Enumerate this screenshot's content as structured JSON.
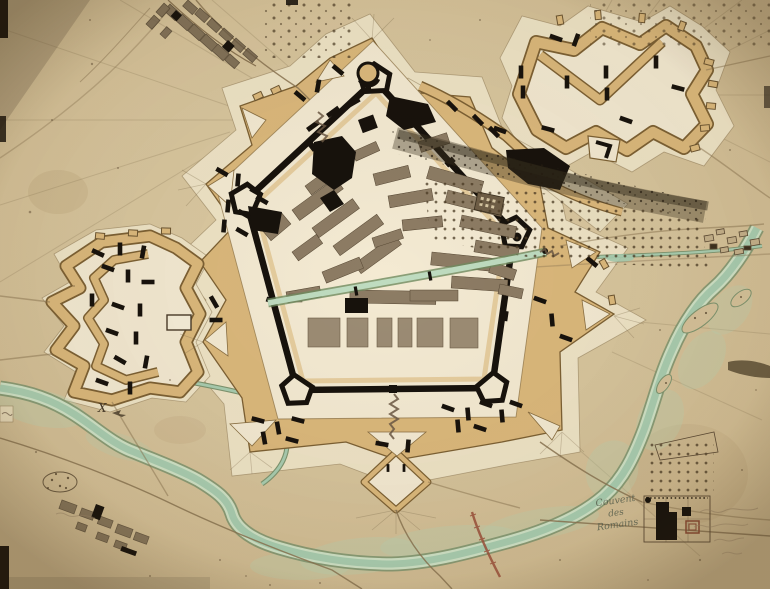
{
  "map": {
    "kind": "hand-drawn fortification plan of a pentagonal star-fort town on aged paper",
    "labels": {
      "convent": {
        "line1": "Couvent",
        "line2": "des",
        "line3": "Romains"
      },
      "x_mark": "X",
      "signature": {
        "note": "faint illegible handwriting, four short lines, lower right corner"
      },
      "village_label": {
        "note": "faint illegible cursive place-name beside south-west village"
      },
      "edge_fragment": {
        "note": "tiny clipped label fragment at left edge"
      }
    },
    "features": [
      "pentagonal citadel wall with five bastions and round north tower",
      "fortified town blocks (north half of citadel)",
      "esplanade with row of barracks blocks (south half)",
      "canal crossing the town",
      "hornwork outwork (north-east)",
      "crownwork outwork (west)",
      "ravelins, glacis and covered way with traverses",
      "south diamond ravelin with zigzag causeway",
      "river with islands (south and east)",
      "mill stream (east)",
      "crownwork moat stream",
      "suburb street grid (north-west)",
      "village (south-west)",
      "convent enclosure with garden and orchard (south-east)",
      "orchard of dotted trees (north-east slope)",
      "dark wooded escarpment shading",
      "small pentagonal redoubt (north-west)"
    ],
    "colors": {
      "paper": "#d5c29a",
      "paper_light": "#e6d6ae",
      "glacis": "#efe4c6",
      "ditch": "#f4ead2",
      "rampart_tan": "#dcb97c",
      "rampart_edge": "#7d6134",
      "ink_black": "#17120c",
      "building_gray": "#8d7c64",
      "building_light": "#9c8c74",
      "water": "#a9cdb0",
      "water_edge": "#7e946f",
      "marsh": "#b9d4b4",
      "road": "#8a7452",
      "shadow": "#3f3422",
      "stain": "#8a6a3c",
      "causeway_red": "#9b4f3a",
      "label_ink": "#57604f",
      "faded_ink": "#9b8668"
    }
  }
}
